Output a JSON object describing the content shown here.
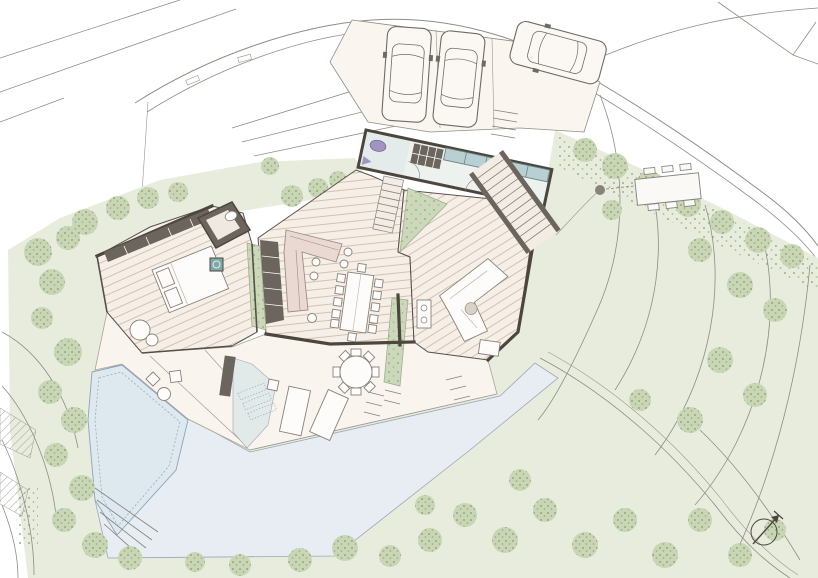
{
  "document": {
    "kind": "architectural site plan",
    "view": "ground floor plan with landscape"
  },
  "colors": {
    "paper": "#ffffff",
    "lawn": "#e7ecdd",
    "tree_base": "#c9d6b6",
    "tree_dot": "#93aa78",
    "floor": "#f6efe7",
    "deck": "#faf4ee",
    "wall": "#4c463f",
    "cabinet": "#6b655d",
    "glazing": "#b9d0d2",
    "entry_floor": "#e3ecea",
    "water": "#e7edf3",
    "pool": "#dde8ef",
    "courtyard": "#ccd8ba",
    "kitchen": "#e9d9d2",
    "fixture_purple": "#a195c0",
    "stove_teal": "#7fa8a8",
    "contour": "#8d8d87",
    "car_body": "#fbf8f4"
  },
  "site": {
    "parked_cars": 3,
    "pools": 1,
    "wings": 3,
    "planted_courtyards": 3,
    "sun_loungers": 2,
    "dining_table_seats": 12,
    "round_table_seats": 8,
    "north_arrow_direction": "north-east"
  }
}
